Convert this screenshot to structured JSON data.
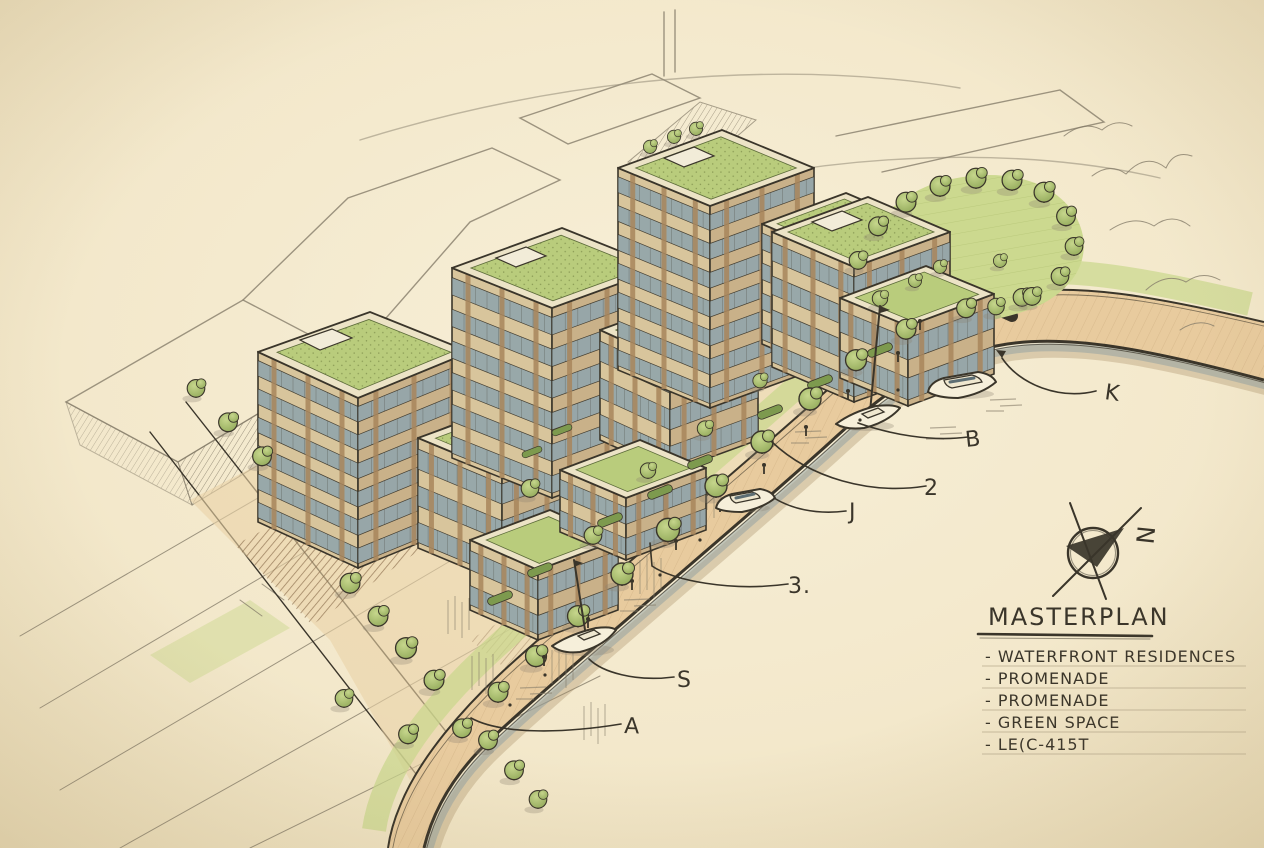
{
  "alt": "Hand-drawn architectural masterplan sketch: waterfront residential buildings with green roofs, a curving tree-lined promenade along a river with boats, a park green space, pencil context buildings and roads, a north arrow, and a hand-lettered legend",
  "palette": {
    "paper": "#f3e9cd",
    "paper_edge": "#e7d9b6",
    "ink": "#3a352a",
    "pencil": "#867d6a",
    "promenade": "#e8cb9e",
    "green_roof": "#b9cc7c",
    "lawn": "#c9d78c",
    "tree": "#a3b96b",
    "tree_dark": "#7d9a4e",
    "facade": "#d8c59c",
    "facade_side": "#c9b189",
    "brick": "#a9865c",
    "glass": "#93a6ab",
    "water_shade": "#8fa0a2",
    "shadow": "#8d6f4e"
  },
  "legend": {
    "title": "MASTERPLAN",
    "items": [
      "- WATERFRONT RESIDENCES",
      "- PROMENADE",
      "- PROMENADE",
      "- GREEN SPACE",
      "- LE(C-415T"
    ]
  },
  "annotations": [
    {
      "label": "K"
    },
    {
      "label": "B"
    },
    {
      "label": "2"
    },
    {
      "label": "J"
    },
    {
      "label": "3."
    },
    {
      "label": "S"
    },
    {
      "label": "A"
    }
  ],
  "compass": {
    "letter": "N"
  }
}
